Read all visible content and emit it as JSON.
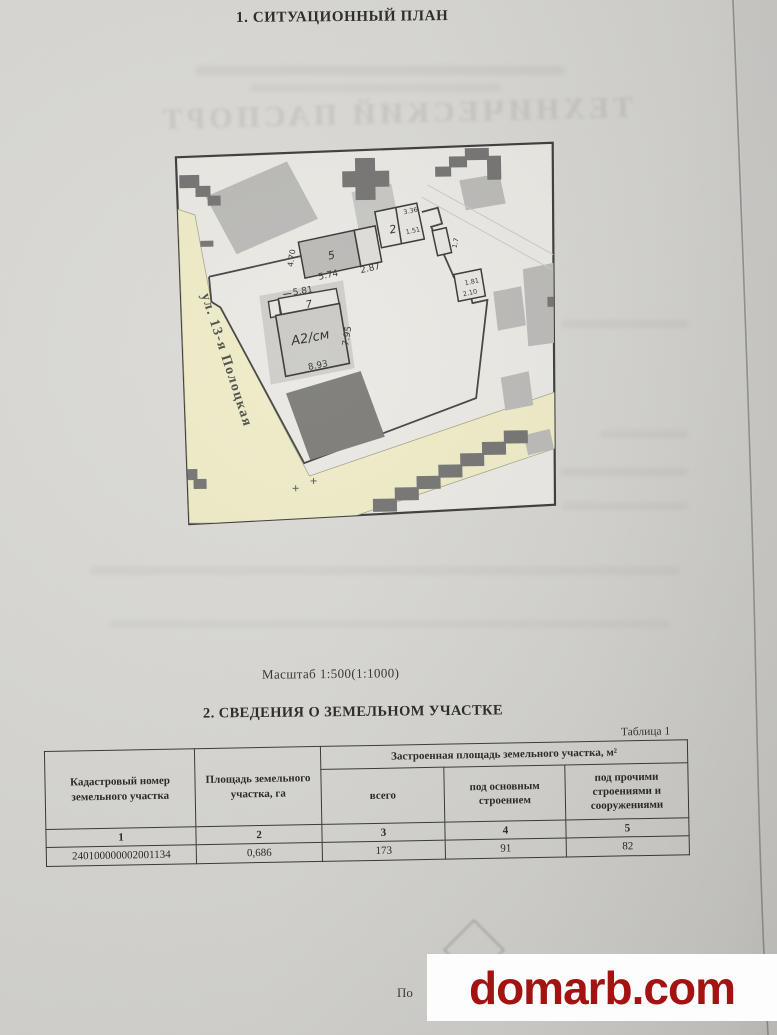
{
  "page": {
    "title": "1. СИТУАЦИОННЫЙ ПЛАН",
    "scale_note": "Масштаб  1:500(1:1000)",
    "section2_title": "2. СВЕДЕНИЯ О ЗЕМЕЛЬНОМ УЧАСТКЕ",
    "bleedthrough_title": "ТЕХНИЧЕСКИЙ ПАСПОРТ",
    "text_fragment": "По"
  },
  "plan": {
    "street_label": "ул. 13-я Полоцкая",
    "buildings": {
      "main_label": "А2/см",
      "annex_label": "7",
      "top_label": "5",
      "cluster_label": "2"
    },
    "dimensions": {
      "d581": "5.81",
      "d795": "7.95",
      "d893": "8.93",
      "d470": "4.70",
      "d574": "5.74",
      "d287": "2.87",
      "d336": "3.36",
      "d151": "1.51",
      "d17": "1.7",
      "d181": "1.81",
      "d210": "2.10"
    },
    "colors": {
      "street": "#edeac4",
      "building_light": "#b7b6b3",
      "building_dark": "#757470",
      "outline": "#2e2d2a"
    }
  },
  "table": {
    "caption": "Таблица 1",
    "col1_header": "Кадастровый номер земельного участка",
    "col2_header": "Площадь земельного участка, га",
    "span_header": "Застроенная площадь земельного участка, м²",
    "col3_header": "всего",
    "col4_header": "под основным строением",
    "col5_header": "под прочими строениями и сооружениями",
    "numbering": [
      "1",
      "2",
      "3",
      "4",
      "5"
    ],
    "row": [
      "240100000002001134",
      "0,686",
      "173",
      "91",
      "82"
    ]
  },
  "watermark": {
    "text": "domarb.com",
    "color": "#a31312"
  }
}
